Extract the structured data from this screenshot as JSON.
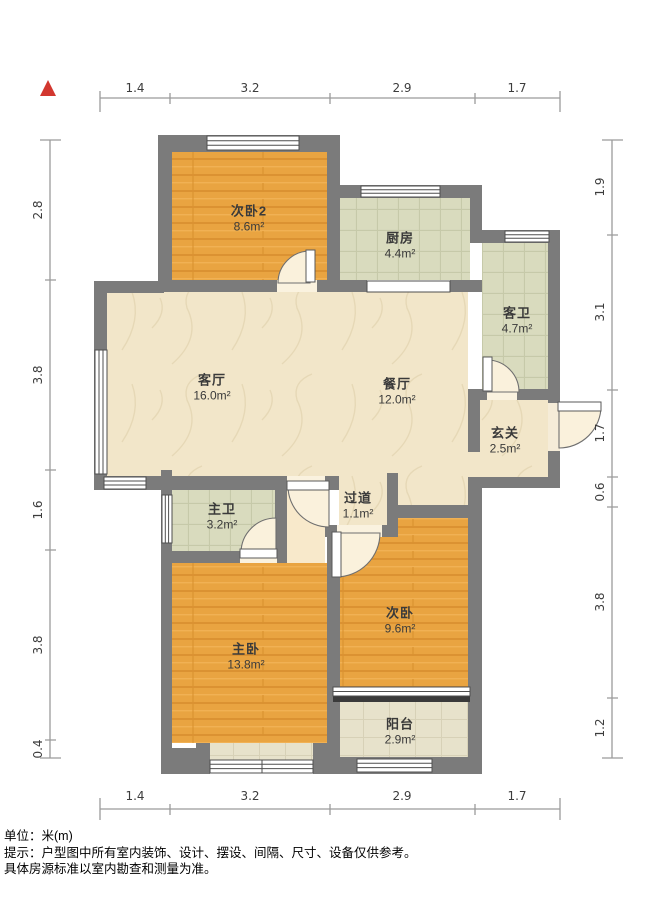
{
  "rooms": [
    {
      "id": "bedroom2",
      "name": "次卧2",
      "area": "8.6m²"
    },
    {
      "id": "kitchen",
      "name": "厨房",
      "area": "4.4m²"
    },
    {
      "id": "guest-bathroom",
      "name": "客卫",
      "area": "4.7m²"
    },
    {
      "id": "living-room",
      "name": "客厅",
      "area": "16.0m²"
    },
    {
      "id": "dining-room",
      "name": "餐厅",
      "area": "12.0m²"
    },
    {
      "id": "entryway",
      "name": "玄关",
      "area": "2.5m²"
    },
    {
      "id": "hallway",
      "name": "过道",
      "area": "1.1m²"
    },
    {
      "id": "master-bathroom",
      "name": "主卫",
      "area": "3.2m²"
    },
    {
      "id": "master-bedroom",
      "name": "主卧",
      "area": "13.8m²"
    },
    {
      "id": "bedroom",
      "name": "次卧",
      "area": "9.6m²"
    },
    {
      "id": "balcony",
      "name": "阳台",
      "area": "2.9m²"
    }
  ],
  "dimensions": {
    "top": [
      "1.4",
      "3.2",
      "2.9",
      "1.7"
    ],
    "bottom": [
      "1.4",
      "3.2",
      "2.9",
      "1.7"
    ],
    "left": [
      "2.8",
      "3.8",
      "1.6",
      "3.8",
      "0.4"
    ],
    "right": [
      "1.9",
      "3.1",
      "1.7",
      "0.6",
      "3.8",
      "1.2"
    ]
  },
  "footer": {
    "unit_line": "单位：米(m)",
    "tip_line1": "提示：户型图中所有室内装饰、设计、摆设、间隔、尺寸、设备仅供参考。",
    "tip_line2": "具体房源标准以室内勘查和测量为准。"
  },
  "colors": {
    "wall": "#7b7b7b",
    "wood_floor": "#e9a441",
    "tile_floor": "#d9dbbe",
    "beige_floor": "#f2e6c9",
    "balcony_tile": "#e7e2cb",
    "north_marker_red": "#d2372f",
    "dimension_line": "#9b9b9b",
    "label_text": "#3a3a3a"
  }
}
